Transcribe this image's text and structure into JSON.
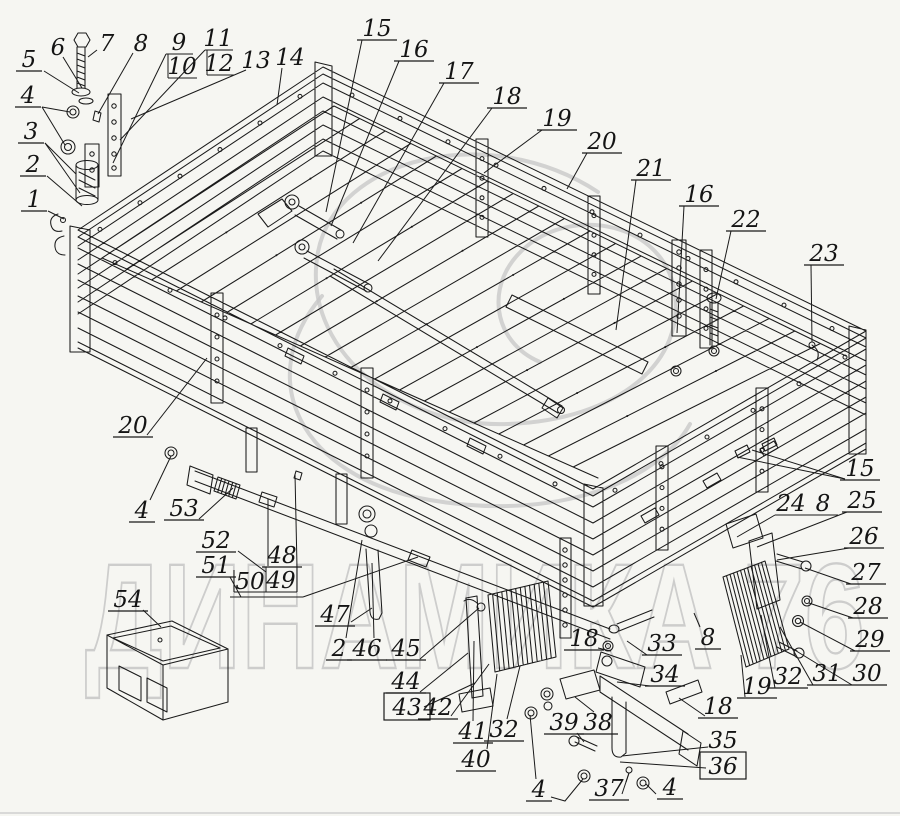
{
  "watermark": {
    "text": "ДИНАМИКА 76",
    "color": "#c6c6c6"
  },
  "diagram": {
    "width": 900,
    "height": 816,
    "background": "#f6f6f2",
    "line_color": "#1a1a1a"
  },
  "callouts": [
    {
      "t": "6",
      "x": 58,
      "y": 47,
      "leads": [
        [
          [
            63,
            57
          ],
          [
            82,
            88
          ]
        ]
      ]
    },
    {
      "t": "7",
      "x": 107,
      "y": 43,
      "leads": [
        [
          [
            97,
            50
          ],
          [
            88,
            57
          ]
        ]
      ]
    },
    {
      "t": "5",
      "x": 29,
      "y": 59,
      "ul": true,
      "leads": [
        [
          [
            44,
            71
          ],
          [
            79,
            93
          ]
        ]
      ]
    },
    {
      "t": "8",
      "x": 141,
      "y": 43,
      "leads": [
        [
          [
            133,
            53
          ],
          [
            98,
            114
          ]
        ]
      ]
    },
    {
      "t": "9",
      "x": 179,
      "y": 42,
      "leads": [
        [
          [
            166,
            54
          ],
          [
            193,
            54
          ]
        ],
        [
          [
            166,
            54
          ],
          [
            113,
            163
          ]
        ]
      ]
    },
    {
      "t": "10",
      "x": 182,
      "y": 66,
      "leads": [
        [
          [
            168,
            78
          ],
          [
            197,
            78
          ]
        ],
        [
          [
            168,
            54
          ],
          [
            168,
            78
          ]
        ]
      ]
    },
    {
      "t": "11",
      "x": 218,
      "y": 38,
      "leads": [
        [
          [
            205,
            50
          ],
          [
            233,
            50
          ]
        ],
        [
          [
            205,
            50
          ],
          [
            120,
            140
          ]
        ]
      ]
    },
    {
      "t": "12",
      "x": 219,
      "y": 63,
      "leads": [
        [
          [
            207,
            75
          ],
          [
            234,
            75
          ]
        ],
        [
          [
            207,
            50
          ],
          [
            207,
            75
          ]
        ]
      ]
    },
    {
      "t": "13",
      "x": 256,
      "y": 60,
      "leads": [
        [
          [
            246,
            70
          ],
          [
            131,
            119
          ]
        ]
      ]
    },
    {
      "t": "14",
      "x": 290,
      "y": 57,
      "leads": [
        [
          [
            282,
            68
          ],
          [
            277,
            105
          ]
        ]
      ]
    },
    {
      "t": "4",
      "x": 28,
      "y": 95,
      "ul": true,
      "leads": [
        [
          [
            42,
            107
          ],
          [
            70,
            112
          ]
        ],
        [
          [
            42,
            107
          ],
          [
            65,
            145
          ]
        ]
      ]
    },
    {
      "t": "3",
      "x": 31,
      "y": 131,
      "ul": true,
      "leads": [
        [
          [
            45,
            143
          ],
          [
            76,
            174
          ]
        ],
        [
          [
            45,
            143
          ],
          [
            80,
            193
          ]
        ]
      ]
    },
    {
      "t": "2",
      "x": 33,
      "y": 164,
      "ul": true,
      "leads": [
        [
          [
            47,
            176
          ],
          [
            82,
            206
          ]
        ]
      ]
    },
    {
      "t": "1",
      "x": 34,
      "y": 199,
      "ul": true,
      "leads": [
        [
          [
            48,
            211
          ],
          [
            64,
            219
          ]
        ]
      ]
    },
    {
      "t": "15",
      "x": 377,
      "y": 28,
      "ul": true,
      "leads": [
        [
          [
            362,
            40
          ],
          [
            326,
            212
          ]
        ]
      ]
    },
    {
      "t": "16",
      "x": 414,
      "y": 49,
      "ul": true,
      "leads": [
        [
          [
            399,
            61
          ],
          [
            331,
            226
          ]
        ]
      ]
    },
    {
      "t": "17",
      "x": 459,
      "y": 71,
      "ul": true,
      "leads": [
        [
          [
            444,
            83
          ],
          [
            353,
            243
          ]
        ]
      ]
    },
    {
      "t": "18",
      "x": 507,
      "y": 96,
      "ul": true,
      "leads": [
        [
          [
            492,
            108
          ],
          [
            378,
            261
          ]
        ]
      ]
    },
    {
      "t": "19",
      "x": 557,
      "y": 118,
      "ul": true,
      "leads": [
        [
          [
            542,
            130
          ],
          [
            484,
            173
          ]
        ]
      ]
    },
    {
      "t": "20",
      "x": 602,
      "y": 141,
      "ul": true,
      "leads": [
        [
          [
            587,
            153
          ],
          [
            567,
            189
          ]
        ]
      ]
    },
    {
      "t": "21",
      "x": 651,
      "y": 168,
      "ul": true,
      "leads": [
        [
          [
            636,
            180
          ],
          [
            616,
            330
          ]
        ]
      ]
    },
    {
      "t": "16",
      "x": 699,
      "y": 194,
      "ul": true,
      "leads": [
        [
          [
            684,
            206
          ],
          [
            677,
            333
          ]
        ]
      ]
    },
    {
      "t": "22",
      "x": 746,
      "y": 219,
      "ul": true,
      "leads": [
        [
          [
            731,
            231
          ],
          [
            716,
            299
          ]
        ]
      ]
    },
    {
      "t": "23",
      "x": 824,
      "y": 253,
      "ul": true,
      "leads": [
        [
          [
            811,
            265
          ],
          [
            812,
            342
          ]
        ]
      ]
    },
    {
      "t": "15",
      "x": 860,
      "y": 468,
      "ul": true,
      "leads": [
        [
          [
            845,
            479
          ],
          [
            752,
            450
          ]
        ],
        [
          [
            845,
            479
          ],
          [
            737,
            457
          ]
        ]
      ]
    },
    {
      "t": "24",
      "x": 791,
      "y": 503,
      "leads": [
        [
          [
            775,
            515
          ],
          [
            838,
            515
          ]
        ],
        [
          [
            775,
            515
          ],
          [
            737,
            537
          ]
        ]
      ]
    },
    {
      "t": "8",
      "x": 823,
      "y": 503
    },
    {
      "t": "25",
      "x": 862,
      "y": 500,
      "ul": true,
      "leads": [
        [
          [
            847,
            512
          ],
          [
            757,
            547
          ]
        ]
      ]
    },
    {
      "t": "26",
      "x": 864,
      "y": 536,
      "ul": true,
      "leads": [
        [
          [
            849,
            548
          ],
          [
            777,
            560
          ]
        ]
      ]
    },
    {
      "t": "27",
      "x": 866,
      "y": 572,
      "ul": true,
      "leads": [
        [
          [
            851,
            584
          ],
          [
            805,
            568
          ]
        ]
      ]
    },
    {
      "t": "28",
      "x": 868,
      "y": 606,
      "ul": true,
      "leads": [
        [
          [
            853,
            618
          ],
          [
            809,
            603
          ]
        ]
      ]
    },
    {
      "t": "29",
      "x": 870,
      "y": 639,
      "ul": true,
      "leads": [
        [
          [
            855,
            651
          ],
          [
            800,
            622
          ]
        ]
      ]
    },
    {
      "t": "30",
      "x": 867,
      "y": 673,
      "ul": true,
      "leads": [
        [
          [
            852,
            685
          ],
          [
            793,
            649
          ]
        ]
      ]
    },
    {
      "t": "31",
      "x": 827,
      "y": 673,
      "ul": true,
      "leads": [
        [
          [
            813,
            685
          ],
          [
            780,
            627
          ]
        ]
      ]
    },
    {
      "t": "32",
      "x": 788,
      "y": 676,
      "ul": true,
      "leads": [
        [
          [
            775,
            688
          ],
          [
            761,
            615
          ]
        ]
      ]
    },
    {
      "t": "19",
      "x": 757,
      "y": 686,
      "ul": true,
      "leads": [
        [
          [
            745,
            697
          ],
          [
            741,
            655
          ]
        ]
      ]
    },
    {
      "t": "33",
      "x": 662,
      "y": 643,
      "ul": true,
      "leads": [
        [
          [
            647,
            655
          ],
          [
            627,
            641
          ]
        ]
      ]
    },
    {
      "t": "34",
      "x": 665,
      "y": 674,
      "ul": true,
      "leads": [
        [
          [
            650,
            686
          ],
          [
            617,
            682
          ]
        ]
      ]
    },
    {
      "t": "18",
      "x": 584,
      "y": 638,
      "ul": true,
      "leads": [
        [
          [
            598,
            648
          ],
          [
            611,
            651
          ]
        ]
      ]
    },
    {
      "t": "18",
      "x": 718,
      "y": 706,
      "ul": true,
      "leads": [
        [
          [
            705,
            716
          ],
          [
            679,
            698
          ]
        ]
      ]
    },
    {
      "t": "8",
      "x": 708,
      "y": 637,
      "ul": true,
      "leads": [
        [
          [
            700,
            627
          ],
          [
            694,
            613
          ]
        ]
      ]
    },
    {
      "t": "35",
      "x": 723,
      "y": 740,
      "leads": [
        [
          [
            708,
            747
          ],
          [
            622,
            756
          ]
        ]
      ]
    },
    {
      "t": "36",
      "x": 723,
      "y": 766,
      "box": true,
      "leads": [
        [
          [
            706,
            768
          ],
          [
            620,
            762
          ]
        ]
      ]
    },
    {
      "t": "37",
      "x": 609,
      "y": 788,
      "ul": true,
      "leads": [
        [
          [
            622,
            794
          ],
          [
            629,
            773
          ]
        ]
      ]
    },
    {
      "t": "4",
      "x": 670,
      "y": 787,
      "ul": true,
      "leads": [
        [
          [
            656,
            794
          ],
          [
            646,
            784
          ]
        ]
      ]
    },
    {
      "t": "4",
      "x": 539,
      "y": 789,
      "ul": true,
      "leads": [
        [
          [
            536,
            779
          ],
          [
            530,
            715
          ]
        ],
        [
          [
            551,
            797
          ],
          [
            565,
            801
          ],
          [
            583,
            779
          ]
        ]
      ]
    },
    {
      "t": "39",
      "x": 564,
      "y": 722,
      "ul": true,
      "leads": [
        [
          [
            577,
            733
          ],
          [
            584,
            742
          ]
        ]
      ]
    },
    {
      "t": "38",
      "x": 598,
      "y": 722,
      "ul": true,
      "leads": [
        [
          [
            594,
            712
          ],
          [
            575,
            697
          ]
        ]
      ]
    },
    {
      "t": "45",
      "x": 406,
      "y": 648,
      "ul": true,
      "leads": [
        [
          [
            420,
            659
          ],
          [
            479,
            608
          ]
        ]
      ]
    },
    {
      "t": "44",
      "x": 406,
      "y": 681,
      "ul": true,
      "leads": [
        [
          [
            420,
            692
          ],
          [
            468,
            653
          ]
        ]
      ]
    },
    {
      "t": "43",
      "x": 407,
      "y": 707,
      "box": true,
      "leads": [
        [
          [
            424,
            707
          ],
          [
            475,
            683
          ]
        ]
      ]
    },
    {
      "t": "42",
      "x": 438,
      "y": 707,
      "ul": true,
      "leads": [
        [
          [
            451,
            716
          ],
          [
            489,
            664
          ]
        ]
      ]
    },
    {
      "t": "41",
      "x": 473,
      "y": 731,
      "ul": true,
      "leads": [
        [
          [
            473,
            721
          ],
          [
            474,
            641
          ]
        ]
      ]
    },
    {
      "t": "40",
      "x": 476,
      "y": 759,
      "ul": true,
      "leads": [
        [
          [
            487,
            749
          ],
          [
            497,
            674
          ]
        ]
      ]
    },
    {
      "t": "32",
      "x": 504,
      "y": 729,
      "ul": true,
      "leads": [
        [
          [
            507,
            719
          ],
          [
            520,
            666
          ]
        ]
      ]
    },
    {
      "t": "46",
      "x": 367,
      "y": 648,
      "ul": true,
      "leads": [
        [
          [
            374,
            638
          ],
          [
            372,
            563
          ]
        ]
      ]
    },
    {
      "t": "2",
      "x": 339,
      "y": 648,
      "ul": true,
      "leads": [
        [
          [
            346,
            638
          ],
          [
            362,
            540
          ]
        ]
      ]
    },
    {
      "t": "47",
      "x": 335,
      "y": 614,
      "ul": true,
      "leads": [
        [
          [
            351,
            622
          ],
          [
            372,
            608
          ]
        ]
      ]
    },
    {
      "t": "52",
      "x": 216,
      "y": 540,
      "ul": true,
      "leads": [
        [
          [
            238,
            551
          ],
          [
            266,
            572
          ]
        ]
      ]
    },
    {
      "t": "51",
      "x": 216,
      "y": 565,
      "ul": true,
      "leads": [
        [
          [
            230,
            577
          ],
          [
            241,
            597
          ]
        ],
        [
          [
            230,
            597
          ],
          [
            303,
            597
          ]
        ],
        [
          [
            303,
            597
          ],
          [
            418,
            557
          ]
        ]
      ]
    },
    {
      "t": "48",
      "x": 282,
      "y": 555,
      "ul": true,
      "leads": [
        [
          [
            268,
            566
          ],
          [
            268,
            499
          ]
        ]
      ]
    },
    {
      "t": "49",
      "x": 281,
      "y": 580,
      "leads": [
        [
          [
            234,
            592
          ],
          [
            297,
            592
          ]
        ],
        [
          [
            266,
            567
          ],
          [
            266,
            592
          ]
        ],
        [
          [
            297,
            567
          ],
          [
            297,
            592
          ]
        ],
        [
          [
            297,
            567
          ],
          [
            295,
            474
          ]
        ]
      ]
    },
    {
      "t": "50",
      "x": 250,
      "y": 581,
      "leads": [
        [
          [
            234,
            570
          ],
          [
            234,
            592
          ]
        ]
      ]
    },
    {
      "t": "53",
      "x": 184,
      "y": 508,
      "ul": true,
      "leads": [
        [
          [
            199,
            519
          ],
          [
            233,
            488
          ]
        ]
      ]
    },
    {
      "t": "4",
      "x": 142,
      "y": 510,
      "ul": true,
      "leads": [
        [
          [
            150,
            500
          ],
          [
            171,
            456
          ]
        ]
      ]
    },
    {
      "t": "54",
      "x": 128,
      "y": 599,
      "ul": true,
      "leads": [
        [
          [
            143,
            610
          ],
          [
            161,
            627
          ]
        ]
      ]
    },
    {
      "t": "20",
      "x": 133,
      "y": 425,
      "ul": true,
      "leads": [
        [
          [
            147,
            435
          ],
          [
            207,
            358
          ]
        ]
      ]
    }
  ]
}
